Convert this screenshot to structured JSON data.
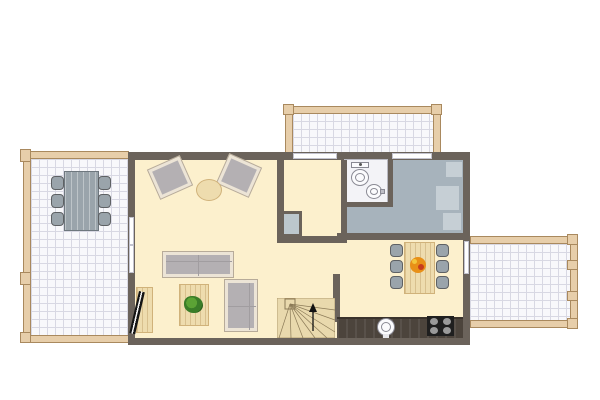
{
  "colors": {
    "background": "#ffffff",
    "wall": "#6b635b",
    "floor-cream": "#fcf0cd",
    "floor-white": "#f8f8fb",
    "grid-line": "#d8d8e3",
    "deck-frame": "#e7ceaa",
    "deck-frame-border": "#a9895e",
    "bedroom-floor": "#a7b3bc",
    "bedroom-furniture": "#c6cfd5",
    "furniture-gray": "#9aa4ab",
    "furniture-gray-dark": "#5e6164",
    "sofa-frame": "#ece4d6",
    "sofa-body": "#b4b0b3",
    "sofa-cushion": "#a19da0",
    "wood-light": "#eedcae",
    "wood-grain": "#d0b27a",
    "counter-dark": "#4c443c",
    "stove-black": "#1f1f1f",
    "burner-gray": "#9a9a9a",
    "plant-green": "#3a7d28",
    "plant-green-dark": "#2b601d",
    "fruit-orange": "#e89018",
    "fruit-red": "#c73c1c",
    "fruit-yellow": "#f3c63c",
    "stair-wood": "#e9d9ad",
    "stair-line": "#7e6d4e",
    "bath-floor": "#f3f3f7",
    "fixture-white": "#fbfbfd",
    "fixture-outline": "#8a8a94"
  },
  "floorplan": {
    "type": "apartment-floor-plan-top-view",
    "rooms": [
      {
        "name": "terrace",
        "side": "west",
        "floor": "white-tile-grid",
        "furniture": [
          "outdoor-dining-table",
          "outdoor-chair",
          "outdoor-chair",
          "outdoor-chair",
          "outdoor-chair",
          "outdoor-chair",
          "outdoor-chair"
        ]
      },
      {
        "name": "living-room",
        "side": "west-interior",
        "floor": "cream",
        "furniture": [
          "armchair",
          "armchair",
          "round-side-table",
          "sofa",
          "coffee-table",
          "potted-plant",
          "loveseat",
          "tv-cabinet",
          "tv"
        ]
      },
      {
        "name": "hallway",
        "side": "center",
        "floor": "cream",
        "furniture": [
          "closet"
        ]
      },
      {
        "name": "bathroom",
        "side": "center-north",
        "floor": "white",
        "furniture": [
          "toilet",
          "washbasin"
        ]
      },
      {
        "name": "bedroom",
        "side": "north-east",
        "floor": "gray-blue",
        "furniture": [
          "cabinet",
          "cabinet",
          "cabinet"
        ]
      },
      {
        "name": "kitchen-dining",
        "side": "south-east",
        "floor": "cream",
        "furniture": [
          "dining-table",
          "dining-chair",
          "dining-chair",
          "dining-chair",
          "dining-chair",
          "dining-chair",
          "dining-chair",
          "fruit-bowl",
          "kitchen-counter",
          "sink",
          "stove"
        ]
      },
      {
        "name": "staircase",
        "side": "south-center",
        "furniture": [
          "winder-stairs",
          "direction-arrow-up"
        ]
      },
      {
        "name": "balcony-north",
        "side": "north",
        "floor": "white-tile-grid",
        "furniture": []
      },
      {
        "name": "balcony-east",
        "side": "east",
        "floor": "white-tile-grid",
        "furniture": []
      }
    ],
    "openings": [
      "window-north-1",
      "window-north-2",
      "window-west",
      "door-east-balcony"
    ]
  }
}
